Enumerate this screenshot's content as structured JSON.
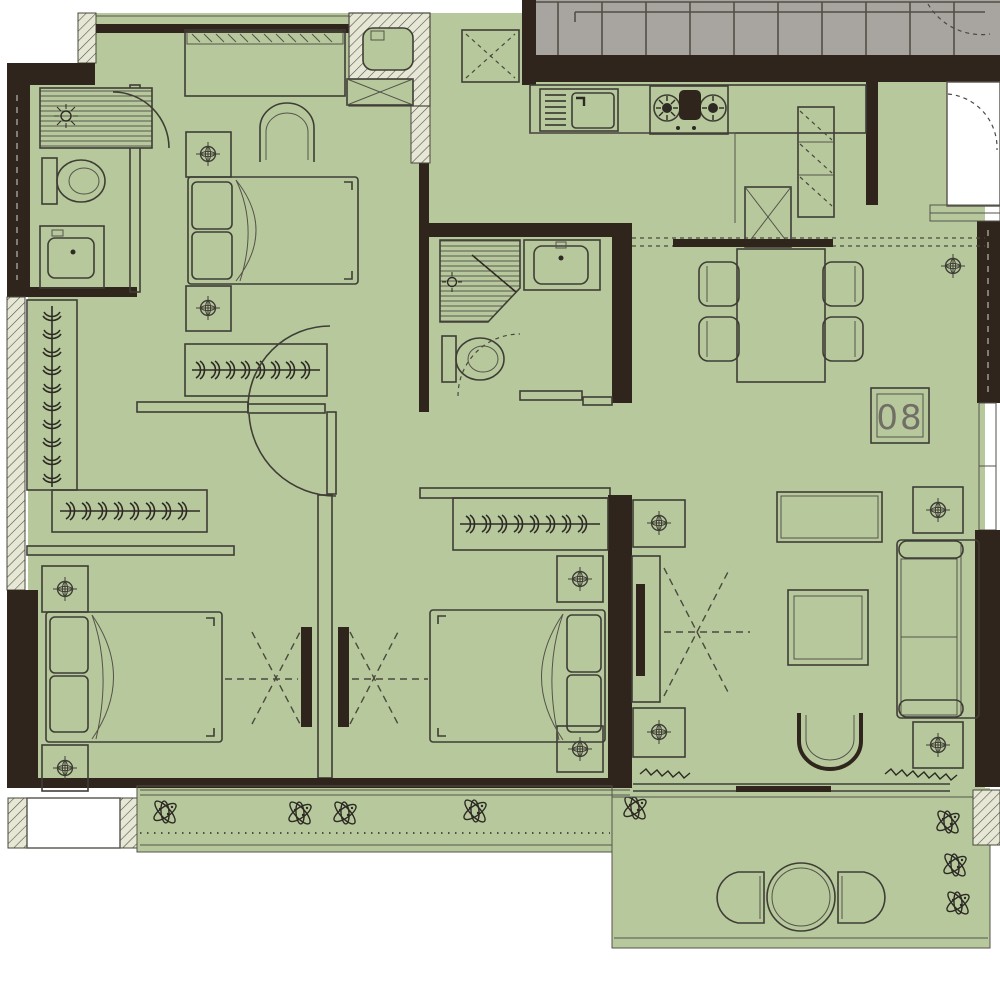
{
  "plan": {
    "title": "apartment-unit-floor-plan",
    "unit_label": "08",
    "colors": {
      "floor": "#b7c99c",
      "wall": "#2f251c",
      "stair": "#a8a5a1",
      "hatch_fill": "#e6e8d5",
      "outline": "#3f3d36",
      "outside": "#ffffff",
      "label_text": "#716e66"
    },
    "rooms": [
      "stairwell",
      "entry",
      "kitchen",
      "dining-area",
      "living-room",
      "hallway",
      "master-bedroom",
      "master-bathroom",
      "walk-in-closet",
      "bathroom-2",
      "bedroom-2",
      "bedroom-3",
      "balcony",
      "planter-bed",
      "ac-platform"
    ],
    "fixtures": [
      "double-bed-master",
      "double-bed-2",
      "double-bed-3",
      "nightstand-lamp x8",
      "wardrobe-hanging-rod x4",
      "sofa",
      "coffee-table",
      "armchair",
      "console-table",
      "tv-cabinet",
      "dining-table",
      "dining-chair x4",
      "refrigerator",
      "tall-cabinet",
      "kitchen-sink",
      "cooktop-2-burner",
      "utility-shaft",
      "vent-shaft",
      "shower x2",
      "toilet x2",
      "vanity-sink x2",
      "balcony-round-table",
      "balcony-chair x2",
      "plants"
    ]
  }
}
